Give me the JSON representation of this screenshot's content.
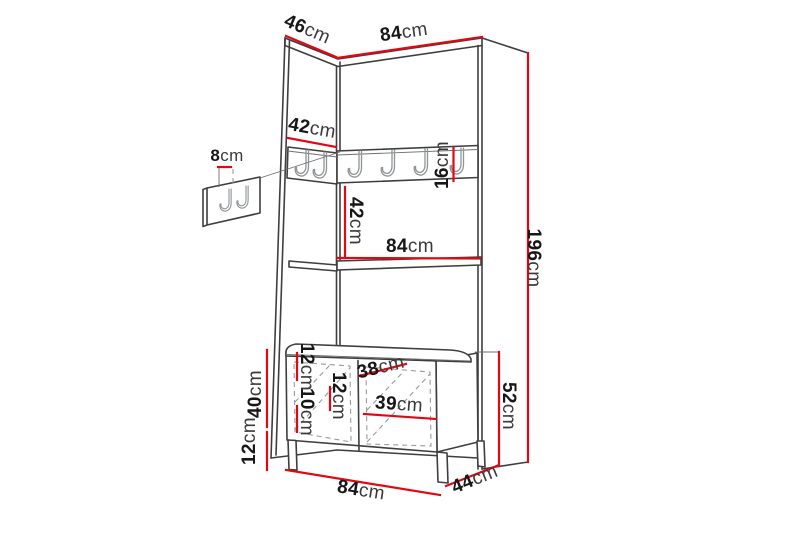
{
  "colors": {
    "dimension_line": "#e30613",
    "outline": "#3e3e3e",
    "text": "#171717",
    "background": "#ffffff"
  },
  "dims": [
    {
      "label": "side-depth-top",
      "value": "46",
      "unit": "cm"
    },
    {
      "label": "width-top",
      "value": "84",
      "unit": "cm"
    },
    {
      "label": "hook-rail-left-width",
      "value": "42",
      "unit": "cm"
    },
    {
      "label": "wall-hook-panel",
      "value": "8",
      "unit": "cm"
    },
    {
      "label": "hook-rail-height",
      "value": "16",
      "unit": "cm"
    },
    {
      "label": "rail-to-shelf",
      "value": "42",
      "unit": "cm"
    },
    {
      "label": "shelf-width",
      "value": "84",
      "unit": "cm"
    },
    {
      "label": "total-height",
      "value": "196",
      "unit": "cm"
    },
    {
      "label": "bench-body-height",
      "value": "40",
      "unit": "cm"
    },
    {
      "label": "bench-leg-height",
      "value": "12",
      "unit": "cm"
    },
    {
      "label": "door-offset-top",
      "value": "12",
      "unit": "cm"
    },
    {
      "label": "door-offset-bottom",
      "value": "10",
      "unit": "cm"
    },
    {
      "label": "door-offset-middle",
      "value": "12",
      "unit": "cm"
    },
    {
      "label": "door-width-left",
      "value": "38",
      "unit": "cm"
    },
    {
      "label": "door-width-right",
      "value": "39",
      "unit": "cm"
    },
    {
      "label": "bench-width",
      "value": "84",
      "unit": "cm"
    },
    {
      "label": "bench-depth",
      "value": "44",
      "unit": "cm"
    },
    {
      "label": "bench-total-height",
      "value": "52",
      "unit": "cm"
    }
  ]
}
